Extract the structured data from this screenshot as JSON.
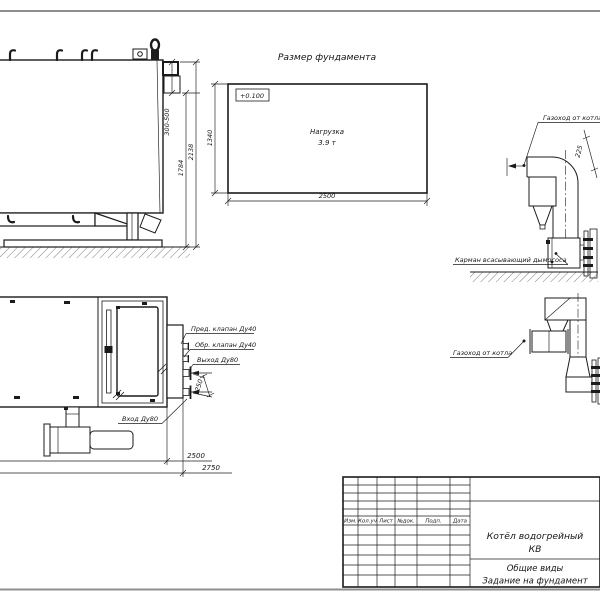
{
  "page": {
    "background": "#ffffff",
    "line_color": "#1b1b1b",
    "frame_color": "#8f8f8f"
  },
  "side_view": {
    "dim_flue_offset": "300-500",
    "dim_body_height": "1784",
    "dim_total_height": "2138"
  },
  "foundation_plan": {
    "title": "Размер фундамента",
    "elevation_mark": "+0.100",
    "load_label": "Нагрузка",
    "load_value": "3.9 т",
    "dim_width": "1340",
    "dim_length": "2500"
  },
  "flue_elevation": {
    "flue_label": "Газоход от котла",
    "dim_duct": "225",
    "pocket_label": "Карман всасывающий дымососа"
  },
  "flue_plan": {
    "flue_label": "Газоход от котла"
  },
  "top_view": {
    "label_safety_valve": "Пред. клапан Ду40",
    "label_check_valve": "Обр. клапан Ду40",
    "label_outlet": "Выход Ду80",
    "label_inlet": "Вход Ду80",
    "dim_nozzle_offset": "250",
    "dim_body_length": "2500",
    "dim_total_length": "2750"
  },
  "title_block": {
    "columns": [
      "Изм.",
      "Кол.уч",
      "Лист",
      "№док.",
      "Подп.",
      "Дата"
    ],
    "title_line1": "Котёл водогрейный",
    "title_line2": "КВ",
    "subtitle_line1": "Общие виды",
    "subtitle_line2": "Задание на фундамент"
  }
}
